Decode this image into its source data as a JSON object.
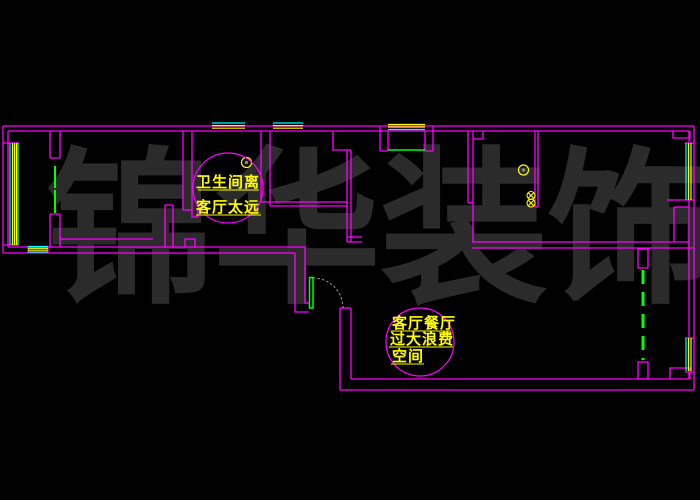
{
  "drawing": {
    "title": "apartment floor plan (CAD)",
    "background_color": "#000000",
    "wall_color": "#FF00FF",
    "window_yellow": "#FFFF00",
    "window_cyan": "#00FFFF",
    "door_green": "#00FF00",
    "arc_gray": "#9a9a9a",
    "watermark": {
      "text": "锦华装饰",
      "chars": [
        "锦",
        "华",
        "装",
        "饰"
      ],
      "color": "#2b2b2b"
    },
    "annotations": [
      {
        "id": "bathroom-note",
        "lines": [
          "卫生间离",
          "客厅太远"
        ],
        "text_color": "#FFFF00",
        "circle_color": "#FF00FF"
      },
      {
        "id": "living-note",
        "lines": [
          "客厅餐厅",
          "过大浪费",
          "空间"
        ],
        "text_color": "#FFFF00",
        "circle_color": "#FF00FF"
      }
    ]
  }
}
